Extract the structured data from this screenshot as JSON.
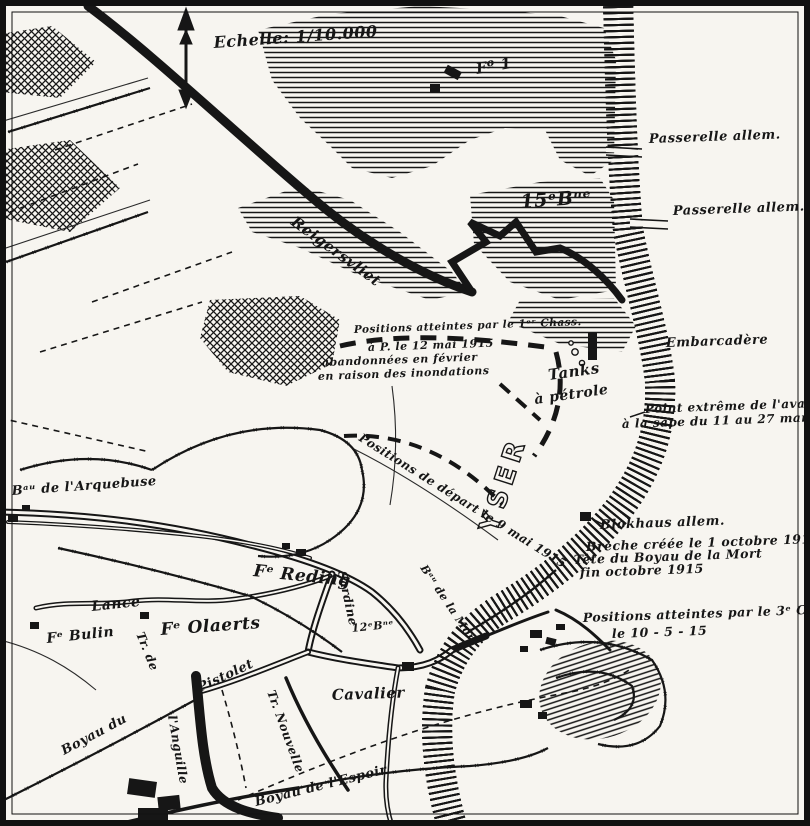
{
  "map": {
    "description": "Hand-drawn French WW1 trench map of the Yser front (Boyau de la Mort sector)",
    "ink_color": "#161616",
    "paper_color": "#f7f5f0",
    "scale": "1/10.000",
    "river_name": "YSER"
  },
  "labels": [
    {
      "id": "scale",
      "text": "Echelle: 1/10.000",
      "x": 214,
      "y": 48,
      "rot": -4,
      "size": 16
    },
    {
      "id": "fort-1",
      "text": "Fº 1",
      "x": 477,
      "y": 74,
      "rot": -10,
      "size": 15
    },
    {
      "id": "bn-15",
      "text": "15ᵉBⁿᵉ",
      "x": 521,
      "y": 208,
      "rot": -4,
      "size": 19
    },
    {
      "id": "passerelle-1",
      "text": "Passerelle allem.",
      "x": 649,
      "y": 143,
      "rot": -2,
      "size": 13
    },
    {
      "id": "passerelle-2",
      "text": "Passerelle allem.",
      "x": 673,
      "y": 215,
      "rot": -2,
      "size": 13
    },
    {
      "id": "reigersvliet",
      "text": "Reigersvliet",
      "x": 290,
      "y": 224,
      "rot": 36,
      "size": 15
    },
    {
      "id": "pos-a-1",
      "text": "Positions atteintes par le 1ᵉʳ Chass.",
      "x": 354,
      "y": 333,
      "rot": -2,
      "size": 10.5
    },
    {
      "id": "pos-a-2",
      "text": "à P. le 12 mai 1915",
      "x": 368,
      "y": 351,
      "rot": -2,
      "size": 11
    },
    {
      "id": "pos-a-3",
      "text": "abandonnées en février",
      "x": 322,
      "y": 366,
      "rot": -2,
      "size": 11
    },
    {
      "id": "pos-a-4",
      "text": "en raison des inondations",
      "x": 318,
      "y": 380,
      "rot": -2,
      "size": 11
    },
    {
      "id": "tanks-1",
      "text": "Tanks",
      "x": 549,
      "y": 380,
      "rot": -8,
      "size": 15
    },
    {
      "id": "tanks-2",
      "text": "à pétrole",
      "x": 535,
      "y": 404,
      "rot": -8,
      "size": 14
    },
    {
      "id": "embarcadere",
      "text": "Embarcadère",
      "x": 666,
      "y": 347,
      "rot": -2,
      "size": 13
    },
    {
      "id": "point-extreme-1",
      "text": "Point extrême de l'avance",
      "x": 645,
      "y": 413,
      "rot": -2,
      "size": 12
    },
    {
      "id": "point-extreme-2",
      "text": "à la sape du 11 au 27 mars 1915",
      "x": 622,
      "y": 428,
      "rot": -2,
      "size": 12
    },
    {
      "id": "river-yser",
      "text": "YSER",
      "x": 496,
      "y": 534,
      "rot": -72,
      "size": 26,
      "cls": "outline"
    },
    {
      "id": "blokhaus",
      "text": "Blokhaus allem.",
      "x": 600,
      "y": 529,
      "rot": -2,
      "size": 13
    },
    {
      "id": "breche-1",
      "text": "Brèche créée le 1 octobre 1915",
      "x": 586,
      "y": 551,
      "rot": -2,
      "size": 12.5
    },
    {
      "id": "breche-2",
      "text": "Tête du Boyau de la Mort",
      "x": 574,
      "y": 564,
      "rot": -2,
      "size": 12.5
    },
    {
      "id": "breche-3",
      "text": "fin octobre 1915",
      "x": 580,
      "y": 577,
      "rot": -2,
      "size": 12.5
    },
    {
      "id": "pos-b-1",
      "text": "Positions atteintes par le 3ᵉ Chass.",
      "x": 583,
      "y": 622,
      "rot": -2,
      "size": 12.5
    },
    {
      "id": "pos-b-2",
      "text": "le 10 - 5 - 15",
      "x": 612,
      "y": 638,
      "rot": -2,
      "size": 12.5
    },
    {
      "id": "arquebuse",
      "text": "Bᵃᵘ de l'Arquebuse",
      "x": 12,
      "y": 495,
      "rot": -4,
      "size": 13
    },
    {
      "id": "lance",
      "text": "Lance",
      "x": 92,
      "y": 611,
      "rot": -6,
      "size": 14
    },
    {
      "id": "fe-bulin",
      "text": "Fᵉ Bulin",
      "x": 47,
      "y": 643,
      "rot": -6,
      "size": 14
    },
    {
      "id": "fe-olaerts",
      "text": "Fᵉ Olaerts",
      "x": 161,
      "y": 635,
      "rot": -4,
      "size": 17
    },
    {
      "id": "fe-reding",
      "text": "Fᵉ Reding",
      "x": 253,
      "y": 576,
      "rot": 6,
      "size": 17
    },
    {
      "id": "sardine",
      "text": "Sardine",
      "x": 338,
      "y": 572,
      "rot": 78,
      "size": 12
    },
    {
      "id": "tr-de",
      "text": "Tr. de",
      "x": 136,
      "y": 634,
      "rot": 68,
      "size": 12
    },
    {
      "id": "depart",
      "text": "Positions de départ le 9 mai 1915",
      "x": 358,
      "y": 440,
      "rot": 32,
      "size": 12
    },
    {
      "id": "bau-mort",
      "text": "Bᵃᵘ de la Mort",
      "x": 420,
      "y": 568,
      "rot": 56,
      "size": 11
    },
    {
      "id": "bn-12",
      "text": "12ᵉBⁿᵉ",
      "x": 352,
      "y": 632,
      "rot": -6,
      "size": 11
    },
    {
      "id": "pistolet",
      "text": "Pistolet",
      "x": 200,
      "y": 692,
      "rot": -25,
      "size": 13
    },
    {
      "id": "cavalier",
      "text": "Cavalier",
      "x": 332,
      "y": 700,
      "rot": -2,
      "size": 15
    },
    {
      "id": "tr-nouvelle",
      "text": "Tr. Nouvelle",
      "x": 267,
      "y": 692,
      "rot": 70,
      "size": 12
    },
    {
      "id": "boyau-du",
      "text": "Boyau du",
      "x": 64,
      "y": 755,
      "rot": -28,
      "size": 13
    },
    {
      "id": "anguille",
      "text": "l'Anguille",
      "x": 168,
      "y": 716,
      "rot": 80,
      "size": 12
    },
    {
      "id": "espoir",
      "text": "Boyau de l'Espoir",
      "x": 256,
      "y": 806,
      "rot": -14,
      "size": 13
    }
  ]
}
